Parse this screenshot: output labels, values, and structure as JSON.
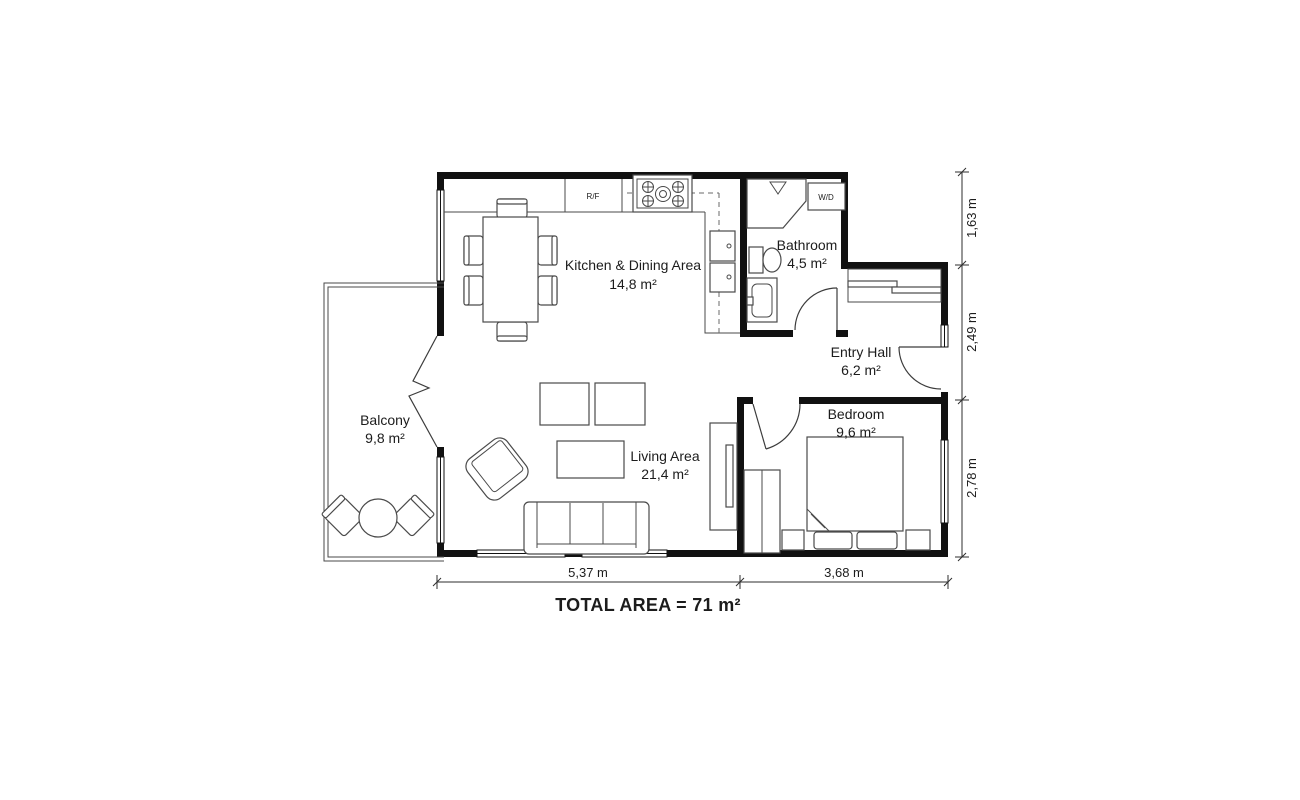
{
  "floorplan": {
    "rooms": {
      "kitchen": {
        "name": "Kitchen & Dining Area",
        "area": "14,8 m²"
      },
      "bathroom": {
        "name": "Bathroom",
        "area": "4,5 m²"
      },
      "entry": {
        "name": "Entry Hall",
        "area": "6,2 m²"
      },
      "bedroom": {
        "name": "Bedroom",
        "area": "9,6 m²"
      },
      "living": {
        "name": "Living Area",
        "area": "21,4 m²"
      },
      "balcony": {
        "name": "Balcony",
        "area": "9,8 m²"
      }
    },
    "appliances": {
      "fridge": "R/F",
      "washer_dryer": "W/D"
    },
    "dimensions": {
      "right": [
        "1,63 m",
        "2,49 m",
        "2,78 m"
      ],
      "bottom": [
        "5,37 m",
        "3,68 m"
      ]
    },
    "total_area": "TOTAL AREA = 71 m²",
    "colors": {
      "wall": "#111111",
      "furniture_line": "#4a4a4a",
      "background": "#ffffff"
    }
  }
}
